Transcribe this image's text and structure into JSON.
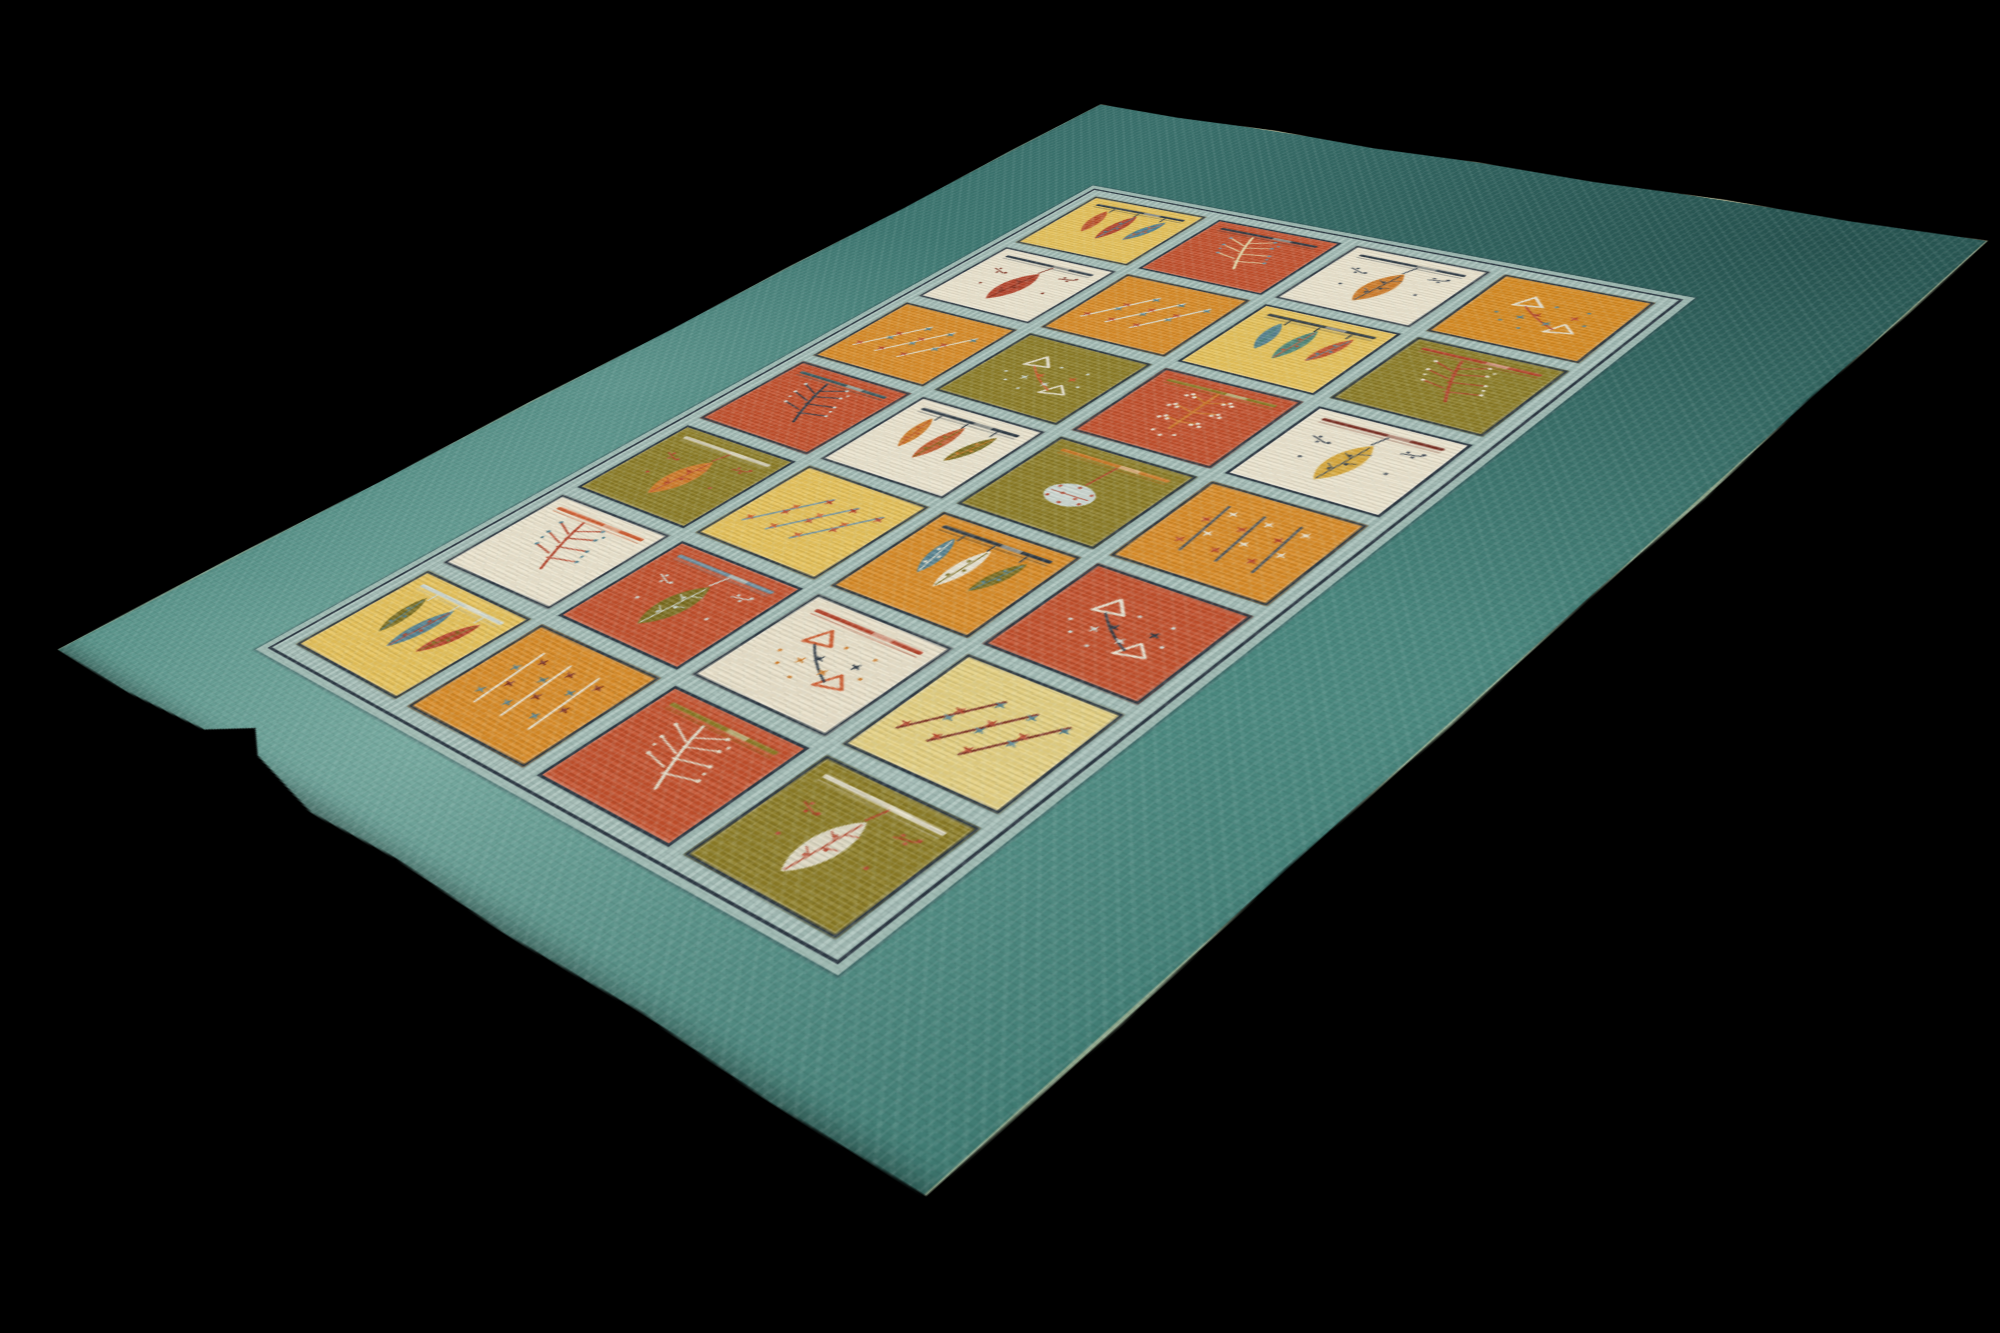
{
  "scene": {
    "background_color": "#000000",
    "subject": "hand-knotted wool Gabbeh rug photographed at an angle on a black background"
  },
  "palette": {
    "background": "#000000",
    "field": "#417c75",
    "field_light": "#74ada2",
    "field_dark": "#2d5c58",
    "edge_binding": "#d3caa2",
    "lattice_band": "#a6beb7",
    "panel_outline": "#2c3742"
  },
  "rug": {
    "grid": {
      "columns": 4,
      "rows": 7
    },
    "panels": [
      {
        "row": 0,
        "col": 0,
        "bg": "#e6c158",
        "motif": "hanging-leaves",
        "rod": "#2c3742",
        "colors": [
          "#c05a2e",
          "#b13f28",
          "#4b7e92"
        ]
      },
      {
        "row": 0,
        "col": 1,
        "bg": "#c24f2b",
        "motif": "branch",
        "rod": "#2c3742",
        "colors": [
          "#e5d8a8",
          "#6f93a4"
        ]
      },
      {
        "row": 0,
        "col": 2,
        "bg": "#ebe3cd",
        "motif": "single-leaf",
        "rod": "#2c3742",
        "colors": [
          "#cf7b28",
          "#3a4450"
        ]
      },
      {
        "row": 0,
        "col": 3,
        "bg": "#d6891f",
        "motif": "triangles",
        "rod": null,
        "colors": [
          "#e8e2d0",
          "#b5432a",
          "#54808e"
        ]
      },
      {
        "row": 1,
        "col": 0,
        "bg": "#ebe3cd",
        "motif": "single-leaf",
        "rod": "#2c3742",
        "colors": [
          "#b5432a",
          "#7d3020"
        ]
      },
      {
        "row": 1,
        "col": 1,
        "bg": "#d88a25",
        "motif": "diag-stems",
        "rod": null,
        "colors": [
          "#dfe4dc",
          "#b5432a",
          "#54808e"
        ]
      },
      {
        "row": 1,
        "col": 2,
        "bg": "#e6c158",
        "motif": "hanging-leaves",
        "rod": "#2c3742",
        "colors": [
          "#54808e",
          "#4f8577",
          "#c0512d"
        ]
      },
      {
        "row": 1,
        "col": 3,
        "bg": "#8c7c25",
        "motif": "branch",
        "rod": "#b5432a",
        "colors": [
          "#b5432a",
          "#e8e2d0"
        ]
      },
      {
        "row": 2,
        "col": 0,
        "bg": "#d88a25",
        "motif": "diag-stems",
        "rod": null,
        "colors": [
          "#e3ddc9",
          "#b5432a",
          "#54808e"
        ]
      },
      {
        "row": 2,
        "col": 1,
        "bg": "#8c7c25",
        "motif": "triangles",
        "rod": null,
        "colors": [
          "#e8e2d0",
          "#cf5b2e",
          "#cfd8d2"
        ]
      },
      {
        "row": 2,
        "col": 2,
        "bg": "#c24f2b",
        "motif": "dots-tree",
        "rod": "#8c7c25",
        "colors": [
          "#cf7b28",
          "#e8e2d0"
        ]
      },
      {
        "row": 2,
        "col": 3,
        "bg": "#ebe3cd",
        "motif": "single-leaf",
        "rod": "#7a2c20",
        "colors": [
          "#d9a93c",
          "#3a4450"
        ]
      },
      {
        "row": 3,
        "col": 0,
        "bg": "#c24f2b",
        "motif": "branch",
        "rod": "#3a5a60",
        "colors": [
          "#2f3a46",
          "#cfd8d2"
        ]
      },
      {
        "row": 3,
        "col": 1,
        "bg": "#ebe3cd",
        "motif": "hanging-leaves",
        "rod": "#2c3742",
        "colors": [
          "#cf7b28",
          "#c05a2e",
          "#7c6d1e"
        ]
      },
      {
        "row": 3,
        "col": 2,
        "bg": "#8c7c25",
        "motif": "round-leaf",
        "rod": "#cf7b28",
        "colors": [
          "#ccd6d0",
          "#b5432a"
        ]
      },
      {
        "row": 3,
        "col": 3,
        "bg": "#d88a25",
        "motif": "vert-stems",
        "rod": null,
        "colors": [
          "#4a5560",
          "#b5432a",
          "#e8e2d0"
        ]
      },
      {
        "row": 4,
        "col": 0,
        "bg": "#8c7c25",
        "motif": "single-leaf",
        "rod": "#d8d2bc",
        "colors": [
          "#cf7b28",
          "#b5432a"
        ]
      },
      {
        "row": 4,
        "col": 1,
        "bg": "#e6c158",
        "motif": "diag-stems",
        "rod": null,
        "colors": [
          "#6f93a4",
          "#cf5b2e",
          "#b5432a"
        ]
      },
      {
        "row": 4,
        "col": 2,
        "bg": "#d88a25",
        "motif": "hanging-leaves",
        "rod": "#2c3742",
        "colors": [
          "#54808e",
          "#e8e2d0",
          "#7c6d1e"
        ]
      },
      {
        "row": 4,
        "col": 3,
        "bg": "#c24f2b",
        "motif": "triangles",
        "rod": null,
        "colors": [
          "#e8e2d0",
          "#2f3a46",
          "#cfd8d2"
        ]
      },
      {
        "row": 5,
        "col": 0,
        "bg": "#ebe3cd",
        "motif": "branch",
        "rod": "#cf5b2e",
        "colors": [
          "#b5432a",
          "#54808e"
        ]
      },
      {
        "row": 5,
        "col": 1,
        "bg": "#c24f2b",
        "motif": "single-leaf",
        "rod": "#6f93a4",
        "colors": [
          "#7c6d1e",
          "#cfd8d2"
        ]
      },
      {
        "row": 5,
        "col": 2,
        "bg": "#e9e0c9",
        "motif": "triangles",
        "rod": "#b5432a",
        "colors": [
          "#cf5b2e",
          "#2f3a46",
          "#cf7b28"
        ]
      },
      {
        "row": 5,
        "col": 3,
        "bg": "#e4cf80",
        "motif": "diag-stems",
        "rod": null,
        "colors": [
          "#7a2c20",
          "#b5432a",
          "#54808e"
        ]
      },
      {
        "row": 6,
        "col": 0,
        "bg": "#e6c158",
        "motif": "hanging-leaves",
        "rod": "#cfd8d2",
        "colors": [
          "#7c6d1e",
          "#54808e",
          "#b5432a"
        ]
      },
      {
        "row": 6,
        "col": 1,
        "bg": "#d88a25",
        "motif": "vert-stems",
        "rod": null,
        "colors": [
          "#e8e2d0",
          "#54808e",
          "#7a2c20"
        ]
      },
      {
        "row": 6,
        "col": 2,
        "bg": "#c24f2b",
        "motif": "branch",
        "rod": "#8c7c25",
        "colors": [
          "#e3ddc9",
          "#e3ddc9"
        ]
      },
      {
        "row": 6,
        "col": 3,
        "bg": "#8c7c25",
        "motif": "single-leaf",
        "rod": "#ded8c2",
        "colors": [
          "#ded8c2",
          "#b5432a"
        ]
      }
    ]
  }
}
